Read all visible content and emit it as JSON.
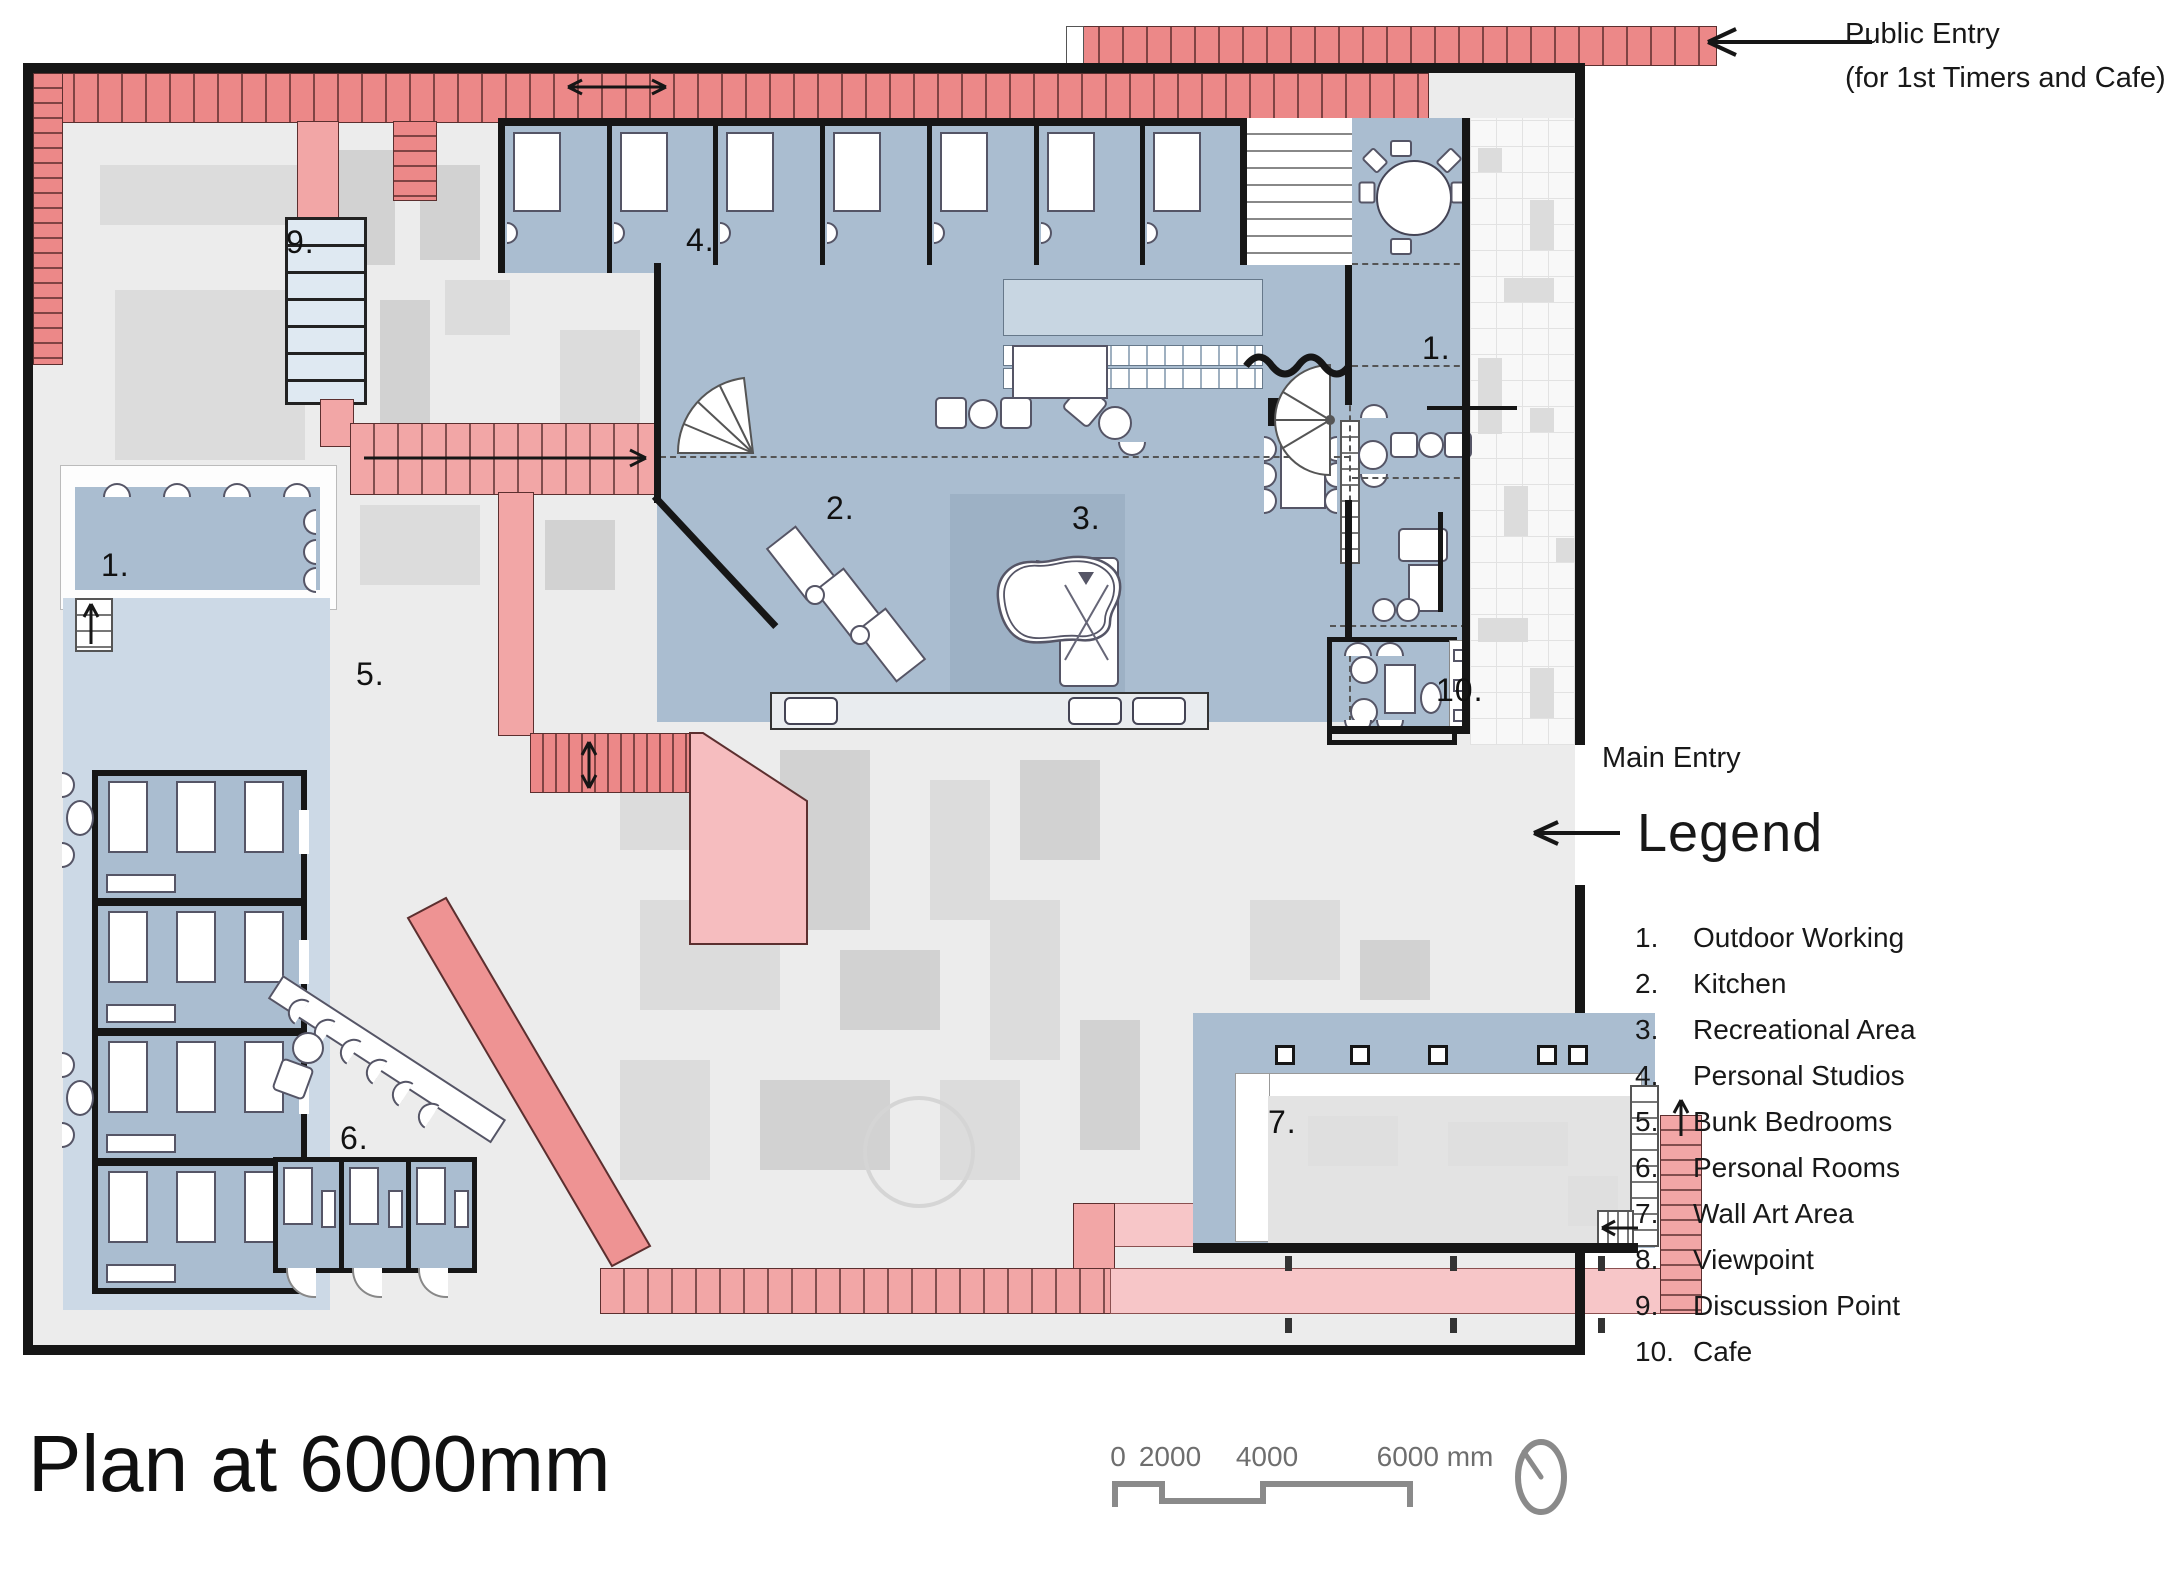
{
  "title": "Plan at 6000mm",
  "annotations": {
    "public_entry_line1": "Public Entry",
    "public_entry_line2": "(for 1st Timers and Cafe)",
    "main_entry": "Main Entry"
  },
  "legend": {
    "heading": "Legend",
    "items": [
      {
        "num": "1.",
        "label": "Outdoor Working"
      },
      {
        "num": "2.",
        "label": "Kitchen"
      },
      {
        "num": "3.",
        "label": "Recreational Area"
      },
      {
        "num": "4.",
        "label": "Personal Studios"
      },
      {
        "num": "5.",
        "label": "Bunk Bedrooms"
      },
      {
        "num": "6.",
        "label": "Personal Rooms"
      },
      {
        "num": "7.",
        "label": "Wall Art Area"
      },
      {
        "num": "8.",
        "label": "Viewpoint"
      },
      {
        "num": "9.",
        "label": "Discussion Point"
      },
      {
        "num": "10.",
        "label": "Cafe"
      }
    ]
  },
  "plan_labels": [
    {
      "text": "9.",
      "x": 286,
      "y": 224
    },
    {
      "text": "4.",
      "x": 686,
      "y": 222
    },
    {
      "text": "1.",
      "x": 1422,
      "y": 330
    },
    {
      "text": "2.",
      "x": 826,
      "y": 490
    },
    {
      "text": "3.",
      "x": 1072,
      "y": 500
    },
    {
      "text": "1.",
      "x": 101,
      "y": 547
    },
    {
      "text": "5.",
      "x": 356,
      "y": 656
    },
    {
      "text": "10.",
      "x": 1436,
      "y": 672
    },
    {
      "text": "8.",
      "x": 732,
      "y": 860
    },
    {
      "text": "6.",
      "x": 340,
      "y": 1120
    },
    {
      "text": "7.",
      "x": 1268,
      "y": 1104
    }
  ],
  "scale_bar": {
    "unit_note": "mm",
    "ticks": [
      {
        "text": "0",
        "x": 1118
      },
      {
        "text": "2000",
        "x": 1170
      },
      {
        "text": "4000",
        "x": 1267
      },
      {
        "text": "6000 mm",
        "x": 1435
      }
    ]
  },
  "colors": {
    "accent_red": "#ec8888",
    "mid_pink": "#f2a6a6",
    "light_pink": "#f7c6c8",
    "room_blue": "#aabdd0",
    "pale_blue": "#ccd9e6",
    "stair_blue": "#dfe9f2",
    "wall_black": "#161616",
    "bg_gray": "#ececec",
    "context_gray": "#dcdcdc",
    "text_dark": "#1c1c1c",
    "scale_gray": "#8a8a8a"
  }
}
